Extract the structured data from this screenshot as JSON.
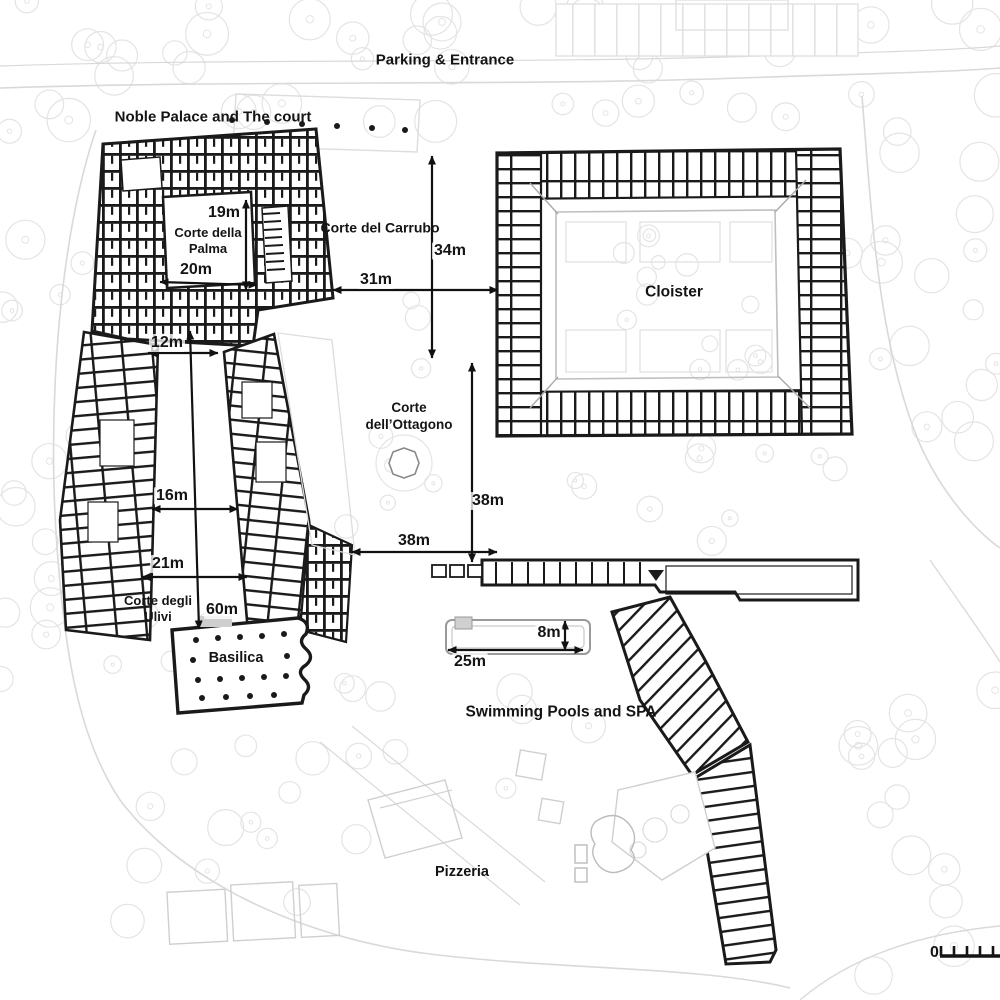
{
  "colors": {
    "ink": "#1a1a1a",
    "dimension": "#111111",
    "faint": "#e3e3e3",
    "road": "#d9d9d9",
    "pool_outline": "#9a9a9a"
  },
  "plan": {
    "area_labels": [
      {
        "id": "parking-entrance",
        "lines": [
          "Parking & Entrance"
        ],
        "x": 445,
        "y": 61,
        "size": 15
      },
      {
        "id": "noble-palace-court",
        "lines": [
          "Noble Palace and The court"
        ],
        "x": 213,
        "y": 118,
        "size": 15
      },
      {
        "id": "corte-della-palma",
        "lines": [
          "Corte della",
          "Palma"
        ],
        "x": 208,
        "y": 241,
        "size": 13
      },
      {
        "id": "corte-del-carrubo",
        "lines": [
          "Corte del Carrubo"
        ],
        "x": 380,
        "y": 228,
        "size": 14
      },
      {
        "id": "cloister",
        "lines": [
          "Cloister"
        ],
        "x": 674,
        "y": 292,
        "size": 15.5
      },
      {
        "id": "corte-dell-ottagono",
        "lines": [
          "Corte",
          "dell’Ottagono"
        ],
        "x": 409,
        "y": 417,
        "size": 13.5,
        "weight": 600
      },
      {
        "id": "corte-degli-ulivi",
        "lines": [
          "Corte degli",
          "Ulivi"
        ],
        "x": 158,
        "y": 609,
        "size": 13
      },
      {
        "id": "basilica",
        "lines": [
          "Basilica"
        ],
        "x": 236,
        "y": 658,
        "size": 14.5
      },
      {
        "id": "swimming-pools-spa",
        "lines": [
          "Swimming Pools and SPA"
        ],
        "x": 561,
        "y": 712,
        "size": 15.5
      },
      {
        "id": "pizzeria",
        "lines": [
          "Pizzeria"
        ],
        "x": 462,
        "y": 872,
        "size": 14.5
      }
    ],
    "dimensions": [
      {
        "id": "19m",
        "value": "19m",
        "x1": 246,
        "y1": 200,
        "x2": 246,
        "y2": 290,
        "lx": 224,
        "ly": 213
      },
      {
        "id": "20m",
        "value": "20m",
        "x1": 160,
        "y1": 282,
        "x2": 257,
        "y2": 285,
        "lx": 196,
        "ly": 270
      },
      {
        "id": "34m",
        "value": "34m",
        "x1": 432,
        "y1": 156,
        "x2": 432,
        "y2": 358,
        "lx": 450,
        "ly": 251
      },
      {
        "id": "31m",
        "value": "31m",
        "x1": 333,
        "y1": 290,
        "x2": 498,
        "y2": 290,
        "lx": 376,
        "ly": 280
      },
      {
        "id": "12m",
        "value": "12m",
        "x1": 148,
        "y1": 353,
        "x2": 218,
        "y2": 353,
        "lx": 167,
        "ly": 343
      },
      {
        "id": "16m",
        "value": "16m",
        "x1": 152,
        "y1": 509,
        "x2": 238,
        "y2": 509,
        "lx": 172,
        "ly": 496
      },
      {
        "id": "21m",
        "value": "21m",
        "x1": 142,
        "y1": 577,
        "x2": 247,
        "y2": 577,
        "lx": 168,
        "ly": 564
      },
      {
        "id": "60m",
        "value": "60m",
        "x1": 190,
        "y1": 331,
        "x2": 199,
        "y2": 629,
        "lx": 222,
        "ly": 610
      },
      {
        "id": "38m-vertical",
        "value": "38m",
        "x1": 472,
        "y1": 363,
        "x2": 472,
        "y2": 562,
        "lx": 488,
        "ly": 501
      },
      {
        "id": "38m-horizontal",
        "value": "38m",
        "x1": 352,
        "y1": 552,
        "x2": 497,
        "y2": 552,
        "lx": 414,
        "ly": 541
      },
      {
        "id": "8m",
        "value": "8m",
        "x1": 565,
        "y1": 621,
        "x2": 565,
        "y2": 650,
        "lx": 549,
        "ly": 633
      },
      {
        "id": "25m",
        "value": "25m",
        "x1": 448,
        "y1": 650,
        "x2": 583,
        "y2": 650,
        "lx": 470,
        "ly": 662
      }
    ],
    "scale_bar": {
      "zero": "0"
    }
  }
}
